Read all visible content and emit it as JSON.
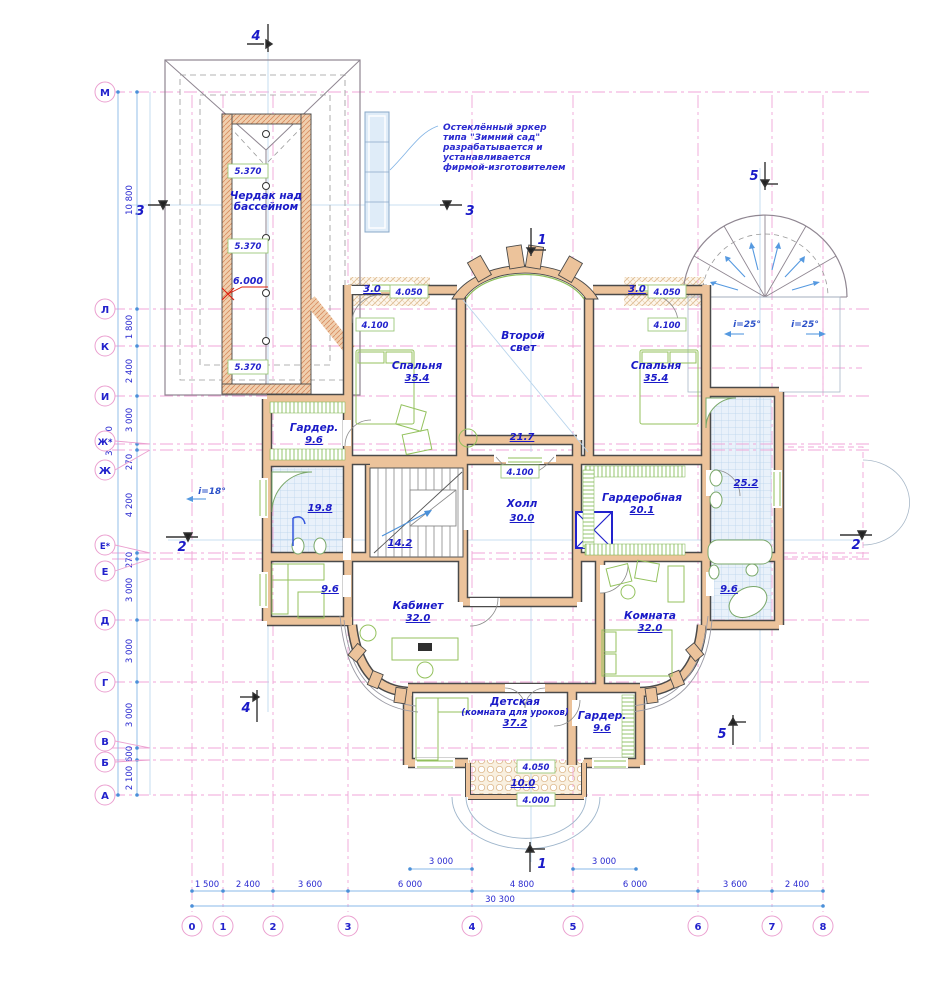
{
  "note": {
    "l1": "Остеклённый эркер",
    "l2": "типа \"Зимний сад\"",
    "l3": "разрабатывается и",
    "l4": "устанавливается",
    "l5": "фирмой-изготовителем"
  },
  "attic": {
    "name1": "Чердак над",
    "name2": "бассейном",
    "level_a": "5.370",
    "level_b": "5.370",
    "level_c": "5.370",
    "ridge": "6.000"
  },
  "rooms": {
    "bedroom_left": {
      "name": "Спальня",
      "area": "35.4",
      "level": "4.100"
    },
    "bedroom_right": {
      "name": "Спальня",
      "area": "35.4",
      "level": "4.100"
    },
    "second_light": {
      "name1": "Второй",
      "name2": "свет"
    },
    "balcony_left": {
      "area": "3.0",
      "level": "4.050"
    },
    "balcony_right": {
      "area": "3.0",
      "level": "4.050"
    },
    "upper_balcony": {
      "area": "21.7",
      "level": "4.100"
    },
    "wardrobe_mid": {
      "name": "Гардер.",
      "area": "9.6"
    },
    "bath_left": {
      "area": "19.8"
    },
    "stairs": {
      "area": "14.2"
    },
    "hall": {
      "name": "Холл",
      "area": "30.0"
    },
    "dressing": {
      "name": "Гардеробная",
      "area": "20.1"
    },
    "bath_right": {
      "area": "25.2"
    },
    "room_small_left": {
      "area": "9.6"
    },
    "cabinet": {
      "name": "Кабинет",
      "area": "32.0"
    },
    "room_right": {
      "name": "Комната",
      "area": "32.0"
    },
    "bath_small_right": {
      "area": "9.6"
    },
    "nursery": {
      "name": "Детская",
      "sub": "(комната для уроков)",
      "area": "37.2"
    },
    "wardrobe_bottom": {
      "name": "Гардер.",
      "area": "9.6"
    },
    "terrace": {
      "area": "10.0",
      "level_top": "4.050",
      "level_bottom": "4.000"
    }
  },
  "slopes": {
    "left": "i=18°",
    "right1": "i=25°",
    "right2": "i=25°"
  },
  "axes": {
    "rows": [
      "М",
      "Л",
      "К",
      "И",
      "Ж*",
      "Ж",
      "Е*",
      "Е",
      "Д",
      "Г",
      "В",
      "Б",
      "А"
    ],
    "row_dims": [
      "10 800",
      "1 800",
      "2 400",
      "3 000",
      "270",
      "4 200",
      "270",
      "3 000",
      "3 000",
      "3 000",
      "600",
      "2 100"
    ],
    "row_total": "34 440",
    "cols": [
      "0",
      "1",
      "2",
      "3",
      "4",
      "5",
      "6",
      "7",
      "8"
    ],
    "col_dims": [
      "1 500",
      "2 400",
      "3 600",
      "6 000",
      "4 800",
      "6 000",
      "3 600",
      "2 400"
    ],
    "col_total": "30 300",
    "local_left": "3 000",
    "local_right": "3 000"
  },
  "sections": {
    "s1": "1",
    "s2": "2",
    "s3": "3",
    "s4": "4",
    "s5": "5"
  }
}
